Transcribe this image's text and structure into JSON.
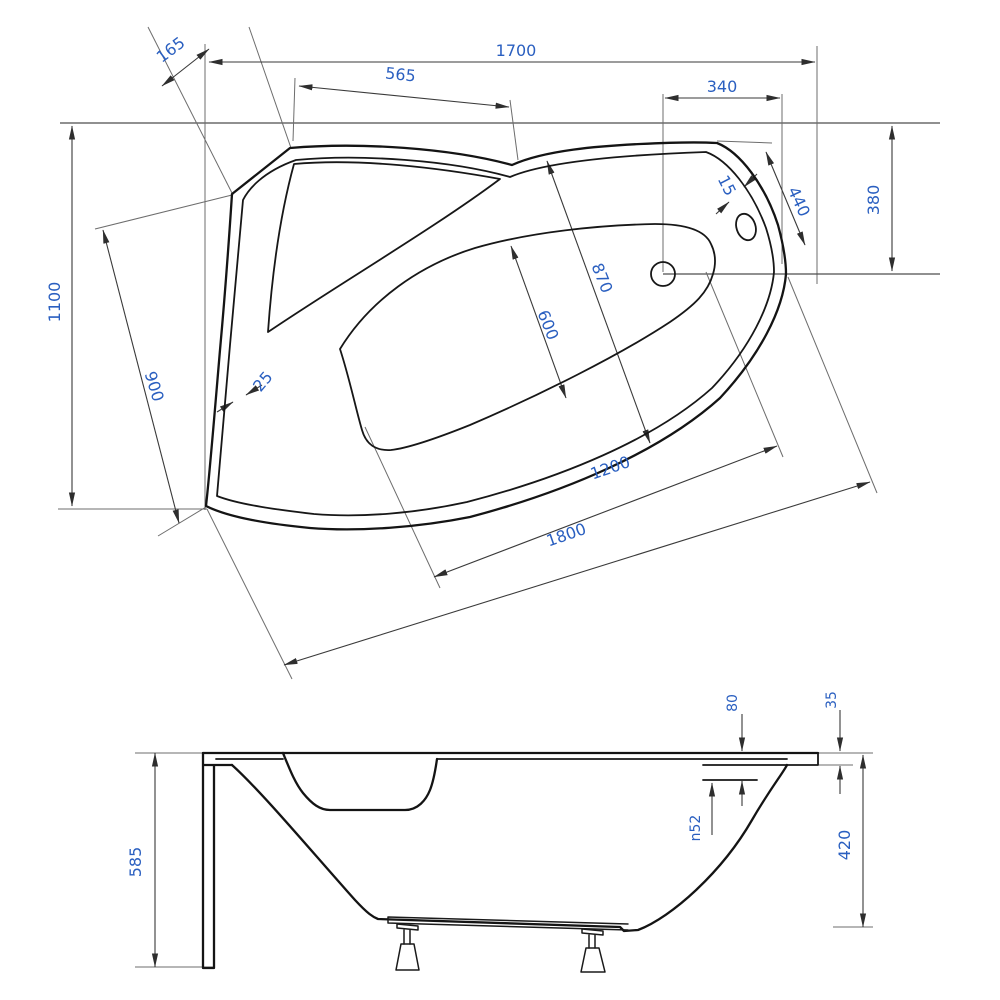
{
  "drawing": {
    "type": "technical-drawing",
    "subject": "asymmetric corner bathtub, plan and side elevation",
    "units": "mm",
    "colors": {
      "line": "#141414",
      "dimension": "#3a3a3a",
      "extension": "#6d6d6d",
      "label": "#2a5fc0",
      "background": "#ffffff"
    },
    "views": {
      "plan": {
        "name": "top-view",
        "dims": {
          "overall_length": "1700",
          "corner_offset": "165",
          "headrest_width": "565",
          "tap_platform_width": "340",
          "overall_width": "1100",
          "corner_side_width": "900",
          "rim_thickness": "25",
          "inner_diagonal_length": "870",
          "inner_diagonal_width": "600",
          "end_edge_gap": "15",
          "end_edge_length": "440",
          "end_width": "380",
          "seat_edge_length": "1200",
          "front_edge_length": "1800"
        }
      },
      "side": {
        "name": "side-view",
        "dims": {
          "total_height": "585",
          "rim_to_overflow": "80",
          "rim_step": "35",
          "overflow_diameter": "n52",
          "shell_depth": "420"
        }
      }
    }
  }
}
